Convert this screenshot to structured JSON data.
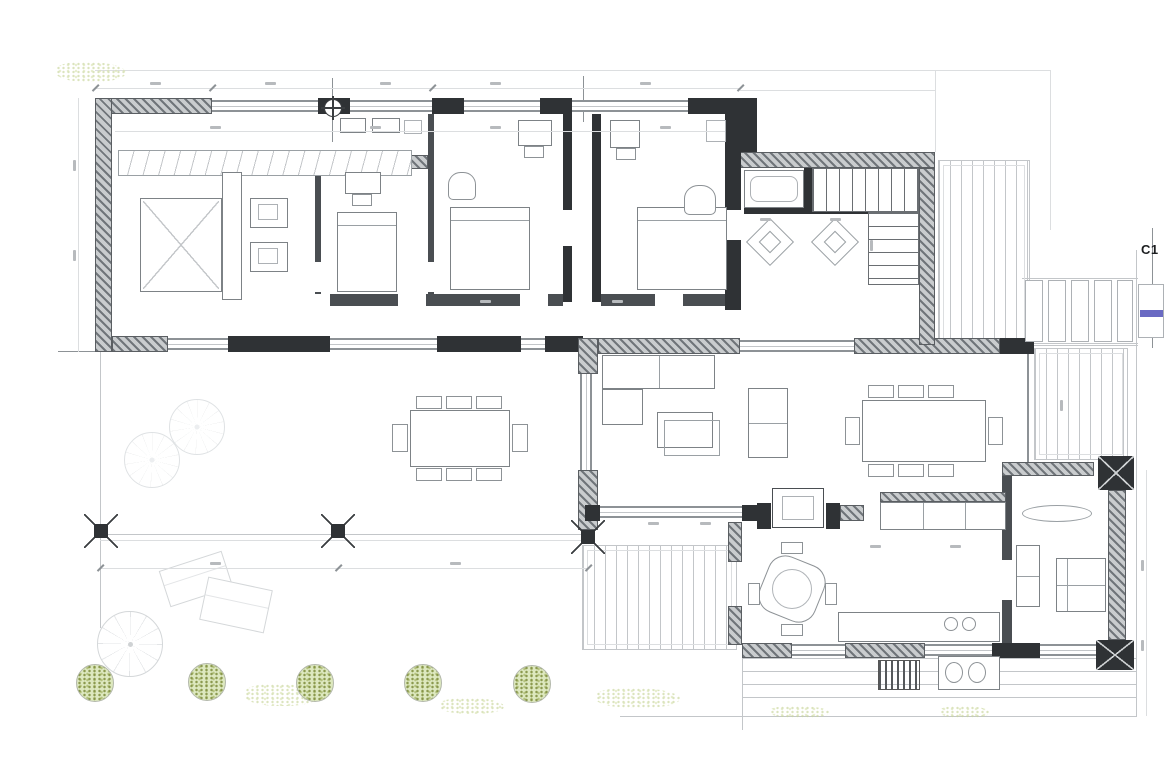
{
  "drawing": {
    "kind": "architectural-floor-plan",
    "section_marker": {
      "label": "C1"
    }
  },
  "colors": {
    "paper": "#ffffff",
    "wall_dark": "#2f3235",
    "hatch_dark": "#70757a",
    "hatch_light": "#c9ccce",
    "line_med": "#8d9296",
    "line_light": "#c3c6c9",
    "line_faint": "#dcdee0",
    "accent_blue": "#5050b8",
    "green_dark": "#9db25e",
    "green_light": "#dde8bf",
    "text_dark": "#1c1e20",
    "chip": "#b7babd"
  }
}
